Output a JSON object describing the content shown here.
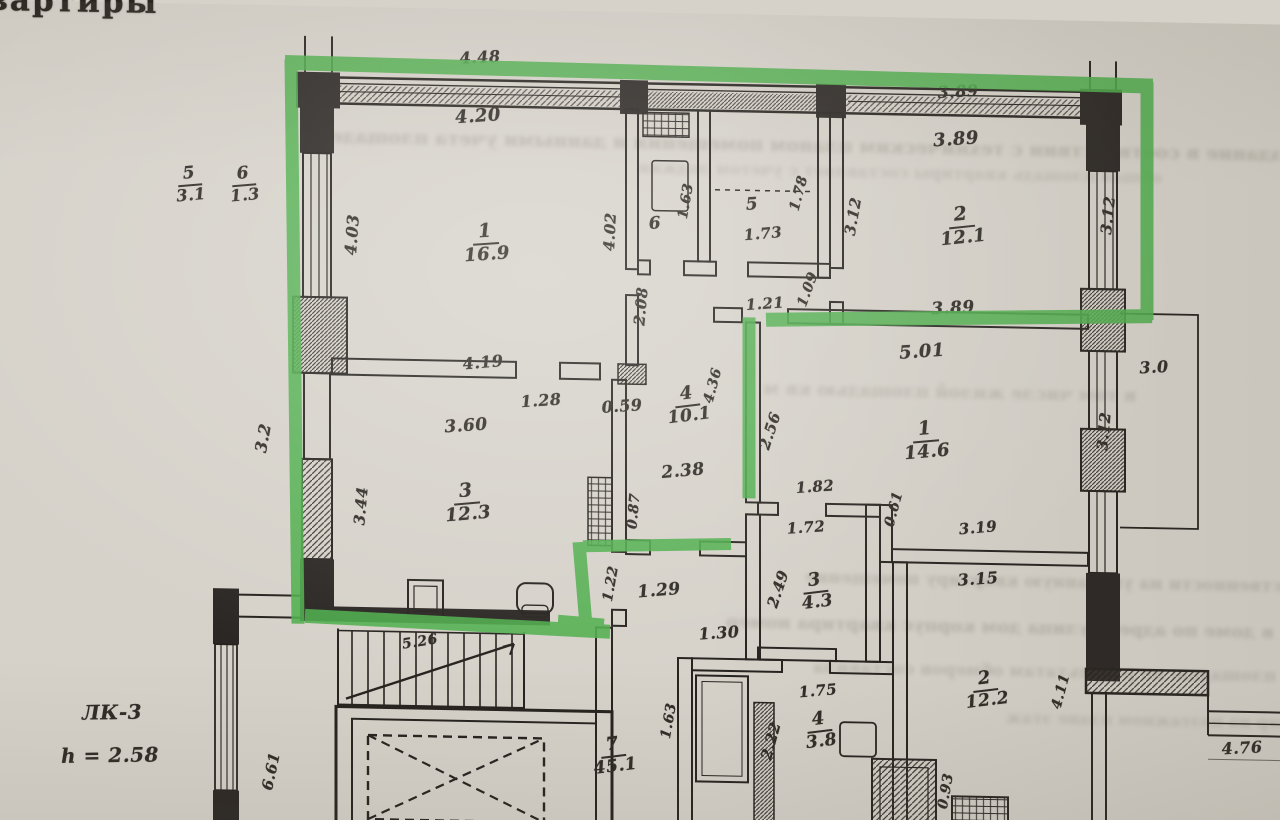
{
  "title": "План Квартиры",
  "colors": {
    "paper": "#d6d2ca",
    "ink": "#26231f",
    "highlight": "#4fae4c"
  },
  "labels": [
    {
      "num": "5",
      "den": "3.1",
      "x": 190,
      "y": 181,
      "s": 17,
      "r": -6
    },
    {
      "num": "6",
      "den": "1.3",
      "x": 244,
      "y": 180,
      "s": 17,
      "r": -6
    },
    {
      "num": "1",
      "den": "16.9",
      "x": 486,
      "y": 234,
      "s": 19,
      "r": -5
    },
    {
      "num": "2",
      "den": "12.1",
      "x": 962,
      "y": 208,
      "s": 19,
      "r": -7
    },
    {
      "num": "3",
      "den": "12.3",
      "x": 467,
      "y": 494,
      "s": 19,
      "r": -6
    },
    {
      "num": "4",
      "den": "10.1",
      "x": 688,
      "y": 392,
      "s": 18,
      "r": -8
    },
    {
      "num": "1",
      "den": "14.6",
      "x": 926,
      "y": 423,
      "s": 19,
      "r": -6
    },
    {
      "num": "2",
      "den": "12.2",
      "x": 986,
      "y": 671,
      "s": 18,
      "r": -8
    },
    {
      "num": "3",
      "den": "4.3",
      "x": 816,
      "y": 576,
      "s": 18,
      "r": -8
    },
    {
      "num": "4",
      "den": "3.8",
      "x": 820,
      "y": 715,
      "s": 18,
      "r": -8
    },
    {
      "num": "7",
      "den": "45.1",
      "x": 614,
      "y": 744,
      "s": 18,
      "r": -8
    },
    {
      "t": "5",
      "x": 752,
      "y": 190,
      "s": 17,
      "r": -5
    },
    {
      "t": "1.73",
      "x": 763,
      "y": 219,
      "s": 15,
      "r": -6
    },
    {
      "t": "6",
      "x": 655,
      "y": 211,
      "s": 17,
      "r": -5
    },
    {
      "t": "4.48",
      "x": 480,
      "y": 48,
      "s": 16,
      "r": -4
    },
    {
      "t": "4.20",
      "x": 478,
      "y": 107,
      "s": 18,
      "r": -5
    },
    {
      "t": "3.89",
      "x": 958,
      "y": 73,
      "s": 16,
      "r": -4
    },
    {
      "t": "3.89",
      "x": 956,
      "y": 121,
      "s": 18,
      "r": -5
    },
    {
      "t": "3.89",
      "x": 953,
      "y": 290,
      "s": 17,
      "r": -4
    },
    {
      "t": "5.01",
      "x": 922,
      "y": 334,
      "s": 18,
      "r": -5
    },
    {
      "t": "4.19",
      "x": 483,
      "y": 353,
      "s": 16,
      "r": -6
    },
    {
      "t": "1.28",
      "x": 541,
      "y": 390,
      "s": 16,
      "r": -5
    },
    {
      "t": "0.59",
      "x": 622,
      "y": 394,
      "s": 16,
      "r": -5
    },
    {
      "t": "3.60",
      "x": 466,
      "y": 417,
      "s": 17,
      "r": -5
    },
    {
      "t": "2.38",
      "x": 683,
      "y": 458,
      "s": 17,
      "r": -6
    },
    {
      "t": "1.21",
      "x": 765,
      "y": 289,
      "s": 15,
      "r": -5
    },
    {
      "t": "1.82",
      "x": 815,
      "y": 471,
      "s": 15,
      "r": -5
    },
    {
      "t": "1.72",
      "x": 806,
      "y": 512,
      "s": 15,
      "r": -5
    },
    {
      "t": "3.19",
      "x": 978,
      "y": 509,
      "s": 15,
      "r": -6
    },
    {
      "t": "3.15",
      "x": 978,
      "y": 560,
      "s": 16,
      "r": -5
    },
    {
      "t": "1.29",
      "x": 659,
      "y": 578,
      "s": 17,
      "r": -6
    },
    {
      "t": "1.30",
      "x": 719,
      "y": 619,
      "s": 16,
      "r": -5
    },
    {
      "t": "1.75",
      "x": 818,
      "y": 675,
      "s": 15,
      "r": -6
    },
    {
      "t": "4.76",
      "x": 1242,
      "y": 724,
      "s": 16,
      "r": -4
    },
    {
      "t": "3.0",
      "x": 1154,
      "y": 345,
      "s": 16,
      "r": -4
    },
    {
      "t": "5.26",
      "x": 420,
      "y": 634,
      "s": 14,
      "r": -10
    },
    {
      "t": "ЛК-3",
      "x": 112,
      "y": 710,
      "s": 20,
      "r": -2
    },
    {
      "t": "h = 2.58",
      "x": 110,
      "y": 753,
      "s": 20,
      "r": -2
    },
    {
      "t": "4.03",
      "x": 352,
      "y": 228,
      "s": 16,
      "r": -86
    },
    {
      "t": "4.02",
      "x": 610,
      "y": 220,
      "s": 15,
      "r": -87
    },
    {
      "t": "1.63",
      "x": 686,
      "y": 188,
      "s": 14,
      "r": -80
    },
    {
      "t": "1.78",
      "x": 799,
      "y": 178,
      "s": 14,
      "r": -75
    },
    {
      "t": "3.12",
      "x": 853,
      "y": 200,
      "s": 15,
      "r": -80
    },
    {
      "t": "3.12",
      "x": 1108,
      "y": 194,
      "s": 15,
      "r": -84
    },
    {
      "t": "2.08",
      "x": 641,
      "y": 294,
      "s": 15,
      "r": -85
    },
    {
      "t": "1.09",
      "x": 808,
      "y": 274,
      "s": 14,
      "r": -70
    },
    {
      "t": "4.36",
      "x": 713,
      "y": 372,
      "s": 14,
      "r": -75
    },
    {
      "t": "2.56",
      "x": 770,
      "y": 416,
      "s": 15,
      "r": -72
    },
    {
      "t": "3.12",
      "x": 1104,
      "y": 410,
      "s": 15,
      "r": -85
    },
    {
      "t": "3.2",
      "x": 263,
      "y": 433,
      "s": 16,
      "r": -80
    },
    {
      "t": "3.44",
      "x": 361,
      "y": 499,
      "s": 15,
      "r": -85
    },
    {
      "t": "0.87",
      "x": 634,
      "y": 499,
      "s": 14,
      "r": -85
    },
    {
      "t": "1.22",
      "x": 611,
      "y": 572,
      "s": 14,
      "r": -80
    },
    {
      "t": "2.49",
      "x": 778,
      "y": 574,
      "s": 15,
      "r": -72
    },
    {
      "t": "0.61",
      "x": 894,
      "y": 492,
      "s": 14,
      "r": -75
    },
    {
      "t": "1.63",
      "x": 669,
      "y": 708,
      "s": 14,
      "r": -80
    },
    {
      "t": "2.22",
      "x": 771,
      "y": 726,
      "s": 15,
      "r": -75
    },
    {
      "t": "0.93",
      "x": 946,
      "y": 773,
      "s": 14,
      "r": -80
    },
    {
      "t": "4.11",
      "x": 1061,
      "y": 671,
      "s": 14,
      "r": -75
    },
    {
      "t": "6.61",
      "x": 271,
      "y": 766,
      "s": 15,
      "r": -78
    }
  ],
  "artifacts": {
    "bleed": [
      {
        "t": "здание в соответствии с техническим планом помещения и данными учета площадей",
        "x": 800,
        "y": 130,
        "s": 19,
        "o": 0.28
      },
      {
        "t": "общая площадь квартиры составляет с учетом лоджии",
        "x": 900,
        "y": 155,
        "s": 16,
        "o": 0.2
      },
      {
        "t": "в том числе жилой площадью кв м",
        "x": 950,
        "y": 374,
        "s": 18,
        "o": 0.24
      },
      {
        "t": "собственности на указанную квартиру помещение",
        "x": 1060,
        "y": 562,
        "s": 17,
        "o": 0.26
      },
      {
        "t": "в доме по адресу улица дом корпус квартира номер",
        "x": 1000,
        "y": 608,
        "s": 18,
        "o": 0.28
      },
      {
        "t": "общей площадью по результатам обмеров составила",
        "x": 1080,
        "y": 652,
        "s": 17,
        "o": 0.24
      },
      {
        "t": "номер на поэтажном плане этаж",
        "x": 1160,
        "y": 698,
        "s": 16,
        "o": 0.2
      }
    ]
  }
}
